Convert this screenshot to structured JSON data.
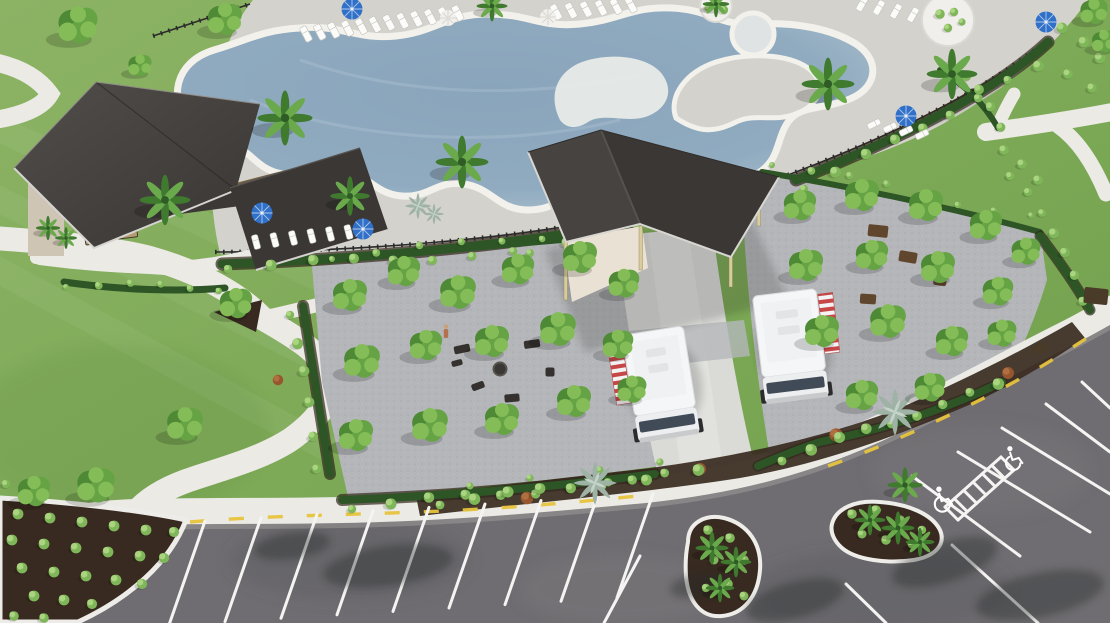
{
  "scene": {
    "title": "Aerial 3D rendering of a community amenity center: freeform resort pool with cabana building, open-air food-truck pavilion, tree-grove courtyards with lounge seating, winding lawn paths and a striped parking lot with accessible spaces",
    "features": [
      "freeform swimming pool with tanning ledge and circular spa",
      "pool deck with rows of white lounge chairs",
      "blue market umbrellas",
      "pool cabana building with dark gable roof",
      "open-air pavilion canopy over food-truck lane",
      "two white food trucks with red-and-white striped awnings",
      "gridded tree groves on paver courtyards with fire-pit seating",
      "serpentine concrete paths through lawn",
      "parking lot with white stalls, yellow curb dashes and two handicap stalls",
      "teardrop landscape islands with palms",
      "mulch beds with clipped round shrubs and silver agaves",
      "black aluminum pool fence"
    ],
    "counts": {
      "food_trucks": 2,
      "blue_umbrellas": 5,
      "white_umbrellas": 2,
      "handicap_symbols": 2,
      "grove_trees": 30,
      "lounge_chairs": 32
    },
    "colors": {
      "lawn": "#7fa854",
      "deck": "#d4d2cc",
      "coping": "#f3f1eb",
      "water": "#8aa4ba",
      "shelf": "#e6e9e7",
      "plaza": "#b4b6b9",
      "concrete": "#dadad7",
      "sidewalk": "#ebeae5",
      "asphalt": "#6f6d71",
      "mulch": "#382a20",
      "hedge": "#2d5526",
      "tree1": "#4e8a35",
      "tree2": "#66a344",
      "tree3": "#84bd57",
      "bush1": "#7fb659",
      "bush2": "#aad480",
      "palm1": "#3f7a2f",
      "palm2": "#6aa94c",
      "roofA": "#474340",
      "roofB": "#3a3734",
      "wall": "#cfc5b4",
      "cream": "#e9e2d4",
      "post": "#d8cc9c",
      "truck": "#f5f6f8",
      "awningred": "#c74747",
      "umbrella": "#3070c8",
      "stripe": "#f4f4f2",
      "yellow": "#e7c33c",
      "fence": "#2b2b2b",
      "agave": "#9fb2a6",
      "rust": "#96572f"
    }
  }
}
